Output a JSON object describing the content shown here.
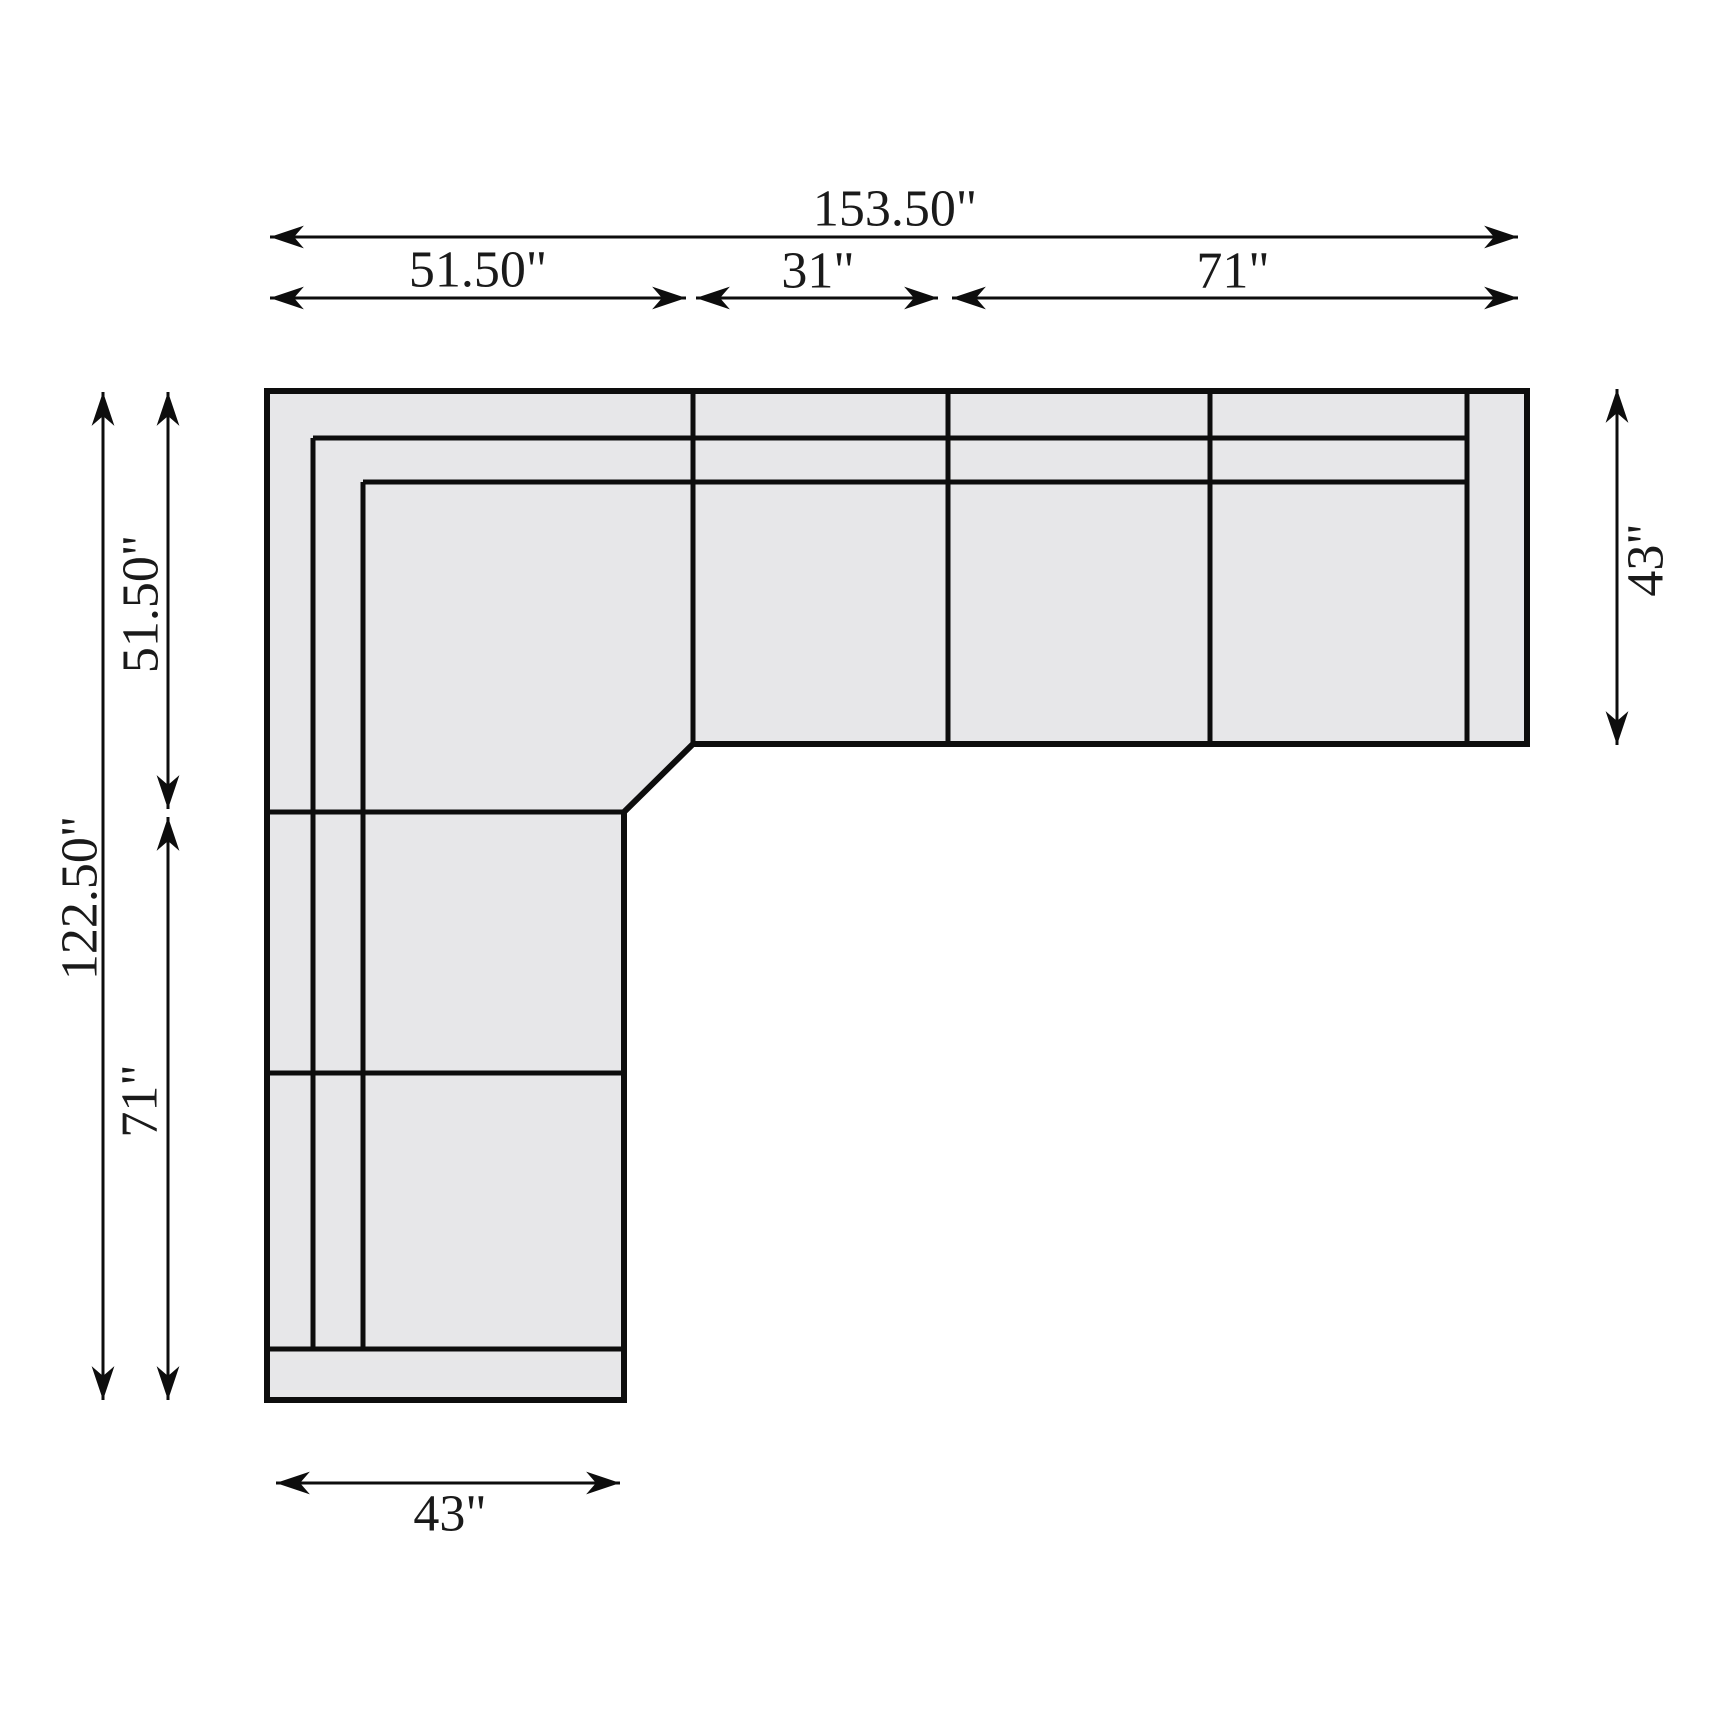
{
  "canvas": {
    "width": 1726,
    "height": 1726,
    "background": "#ffffff"
  },
  "style": {
    "sofa_fill": "#e7e7e9",
    "line_color": "#0d0d0d",
    "text_color": "#1a1a1a",
    "outer_stroke_width": 6,
    "seam_stroke_width": 5,
    "dim_stroke_width": 3,
    "label_font_px": 52
  },
  "sofa": {
    "outline_points": [
      [
        267,
        391
      ],
      [
        1527,
        391
      ],
      [
        1527,
        744
      ],
      [
        693,
        744
      ],
      [
        624,
        812
      ],
      [
        624,
        1400
      ],
      [
        267,
        1400
      ]
    ],
    "seam_lines": [
      {
        "name": "back-rail-seam",
        "x1": 313,
        "y1": 438,
        "x2": 1467,
        "y2": 438
      },
      {
        "name": "back-cushion-seam",
        "x1": 363,
        "y1": 482,
        "x2": 1467,
        "y2": 482
      },
      {
        "name": "left-arm-rail-seam",
        "x1": 313,
        "y1": 438,
        "x2": 313,
        "y2": 1349
      },
      {
        "name": "left-arm-cushion-seam",
        "x1": 363,
        "y1": 482,
        "x2": 363,
        "y2": 1349
      },
      {
        "name": "divider-corner-seat",
        "x1": 693,
        "y1": 391,
        "x2": 693,
        "y2": 744
      },
      {
        "name": "divider-armless-chair",
        "x1": 948,
        "y1": 391,
        "x2": 948,
        "y2": 744
      },
      {
        "name": "divider-loveseat",
        "x1": 1210,
        "y1": 391,
        "x2": 1210,
        "y2": 744
      },
      {
        "name": "right-arm-seam",
        "x1": 1467,
        "y1": 391,
        "x2": 1467,
        "y2": 744
      },
      {
        "name": "leg-divider-upper",
        "x1": 267,
        "y1": 812,
        "x2": 624,
        "y2": 812
      },
      {
        "name": "leg-divider-lower",
        "x1": 267,
        "y1": 1073,
        "x2": 624,
        "y2": 1073
      },
      {
        "name": "leg-end-rail-seam",
        "x1": 267,
        "y1": 1349,
        "x2": 624,
        "y2": 1349
      }
    ]
  },
  "dimensions": [
    {
      "name": "overall-width",
      "text": "153.50\"",
      "x1": 270,
      "y1": 237,
      "x2": 1518,
      "y2": 237,
      "label_x": 895,
      "label_y": 209,
      "rotated": false
    },
    {
      "name": "corner-width",
      "text": "51.50\"",
      "x1": 270,
      "y1": 298,
      "x2": 686,
      "y2": 298,
      "label_x": 478,
      "label_y": 270,
      "rotated": false
    },
    {
      "name": "chair-width",
      "text": "31\"",
      "x1": 696,
      "y1": 298,
      "x2": 938,
      "y2": 298,
      "label_x": 818,
      "label_y": 271,
      "rotated": false
    },
    {
      "name": "loveseat-width",
      "text": "71\"",
      "x1": 952,
      "y1": 298,
      "x2": 1518,
      "y2": 298,
      "label_x": 1233,
      "label_y": 271,
      "rotated": false
    },
    {
      "name": "overall-depth",
      "text": "122.50\"",
      "x1": 103,
      "y1": 392,
      "x2": 103,
      "y2": 1400,
      "label_x": 80,
      "label_y": 898,
      "rotated": true
    },
    {
      "name": "corner-depth",
      "text": "51.50\"",
      "x1": 168,
      "y1": 392,
      "x2": 168,
      "y2": 809,
      "label_x": 141,
      "label_y": 604,
      "rotated": true
    },
    {
      "name": "leg-length",
      "text": "71\"",
      "x1": 168,
      "y1": 817,
      "x2": 168,
      "y2": 1400,
      "label_x": 140,
      "label_y": 1101,
      "rotated": true
    },
    {
      "name": "right-depth",
      "text": "43\"",
      "x1": 1617,
      "y1": 389,
      "x2": 1617,
      "y2": 745,
      "label_x": 1646,
      "label_y": 560,
      "rotated": true
    },
    {
      "name": "leg-width",
      "text": "43\"",
      "x1": 276,
      "y1": 1483,
      "x2": 620,
      "y2": 1483,
      "label_x": 450,
      "label_y": 1514,
      "rotated": false
    }
  ]
}
